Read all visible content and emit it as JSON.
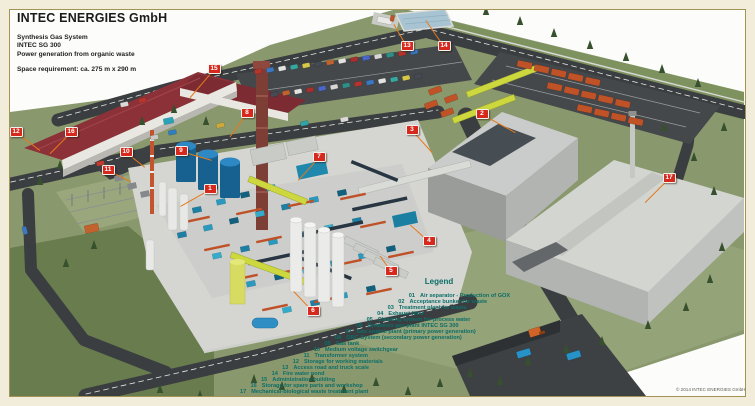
{
  "header": {
    "company": "INTEC ENERGIES GmbH",
    "line1": "Synthesis Gas System",
    "line2": "INTEC SG 300",
    "line3": "Power generation from organic waste",
    "space_requirement": "Space requirement: ca. 275 m x 290 m"
  },
  "legend": {
    "title": "Legend",
    "items": [
      {
        "num": "01",
        "label": "Air separator - Production of GOX"
      },
      {
        "num": "02",
        "label": "Acceptance bunker for waste"
      },
      {
        "num": "03",
        "label": "Treatment plant for waste"
      },
      {
        "num": "04",
        "label": "Exhaust filter"
      },
      {
        "num": "05",
        "label": "Cleaning system for process water"
      },
      {
        "num": "06",
        "label": "Synthesis gas plant INTEC SG 300"
      },
      {
        "num": "07",
        "label": "Gas engine plant (primary power generation)"
      },
      {
        "num": "08",
        "label": "ORC-System (secondary power generation)"
      },
      {
        "num": "09",
        "label": "Gas tank"
      },
      {
        "num": "10",
        "label": "Medium voltage switchgear"
      },
      {
        "num": "11",
        "label": "Transformer system"
      },
      {
        "num": "12",
        "label": "Storage for working materials"
      },
      {
        "num": "13",
        "label": "Access road and truck scale"
      },
      {
        "num": "14",
        "label": "Fire water pond"
      },
      {
        "num": "15",
        "label": "Administration building"
      },
      {
        "num": "16",
        "label": "Storage for spare parts and workshop"
      },
      {
        "num": "17",
        "label": "Mechanical-biological waste treatment plant"
      }
    ]
  },
  "markers": [
    {
      "label": "1",
      "x": 210,
      "y": 189,
      "tx": 180,
      "ty": 206
    },
    {
      "label": "2",
      "x": 482,
      "y": 114,
      "tx": 515,
      "ty": 132
    },
    {
      "label": "3",
      "x": 412,
      "y": 130,
      "tx": 432,
      "ty": 152
    },
    {
      "label": "4",
      "x": 429,
      "y": 241,
      "tx": 410,
      "ty": 224
    },
    {
      "label": "5",
      "x": 391,
      "y": 271,
      "tx": 380,
      "ty": 255
    },
    {
      "label": "6",
      "x": 313,
      "y": 311,
      "tx": 294,
      "ty": 291
    },
    {
      "label": "7",
      "x": 319,
      "y": 157,
      "tx": 298,
      "ty": 180
    },
    {
      "label": "8",
      "x": 247,
      "y": 113,
      "tx": 230,
      "ty": 136
    },
    {
      "label": "9",
      "x": 181,
      "y": 151,
      "tx": 212,
      "ty": 160
    },
    {
      "label": "10",
      "x": 126,
      "y": 152,
      "tx": 145,
      "ty": 167
    },
    {
      "label": "11",
      "x": 108,
      "y": 170,
      "tx": 130,
      "ty": 181
    },
    {
      "label": "12",
      "x": 16,
      "y": 132,
      "tx": 40,
      "ty": 150
    },
    {
      "label": "13",
      "x": 407,
      "y": 46,
      "tx": 394,
      "ty": 24
    },
    {
      "label": "14",
      "x": 444,
      "y": 46,
      "tx": 426,
      "ty": 20
    },
    {
      "label": "15",
      "x": 214,
      "y": 69,
      "tx": 190,
      "ty": 97
    },
    {
      "label": "16",
      "x": 71,
      "y": 132,
      "tx": 50,
      "ty": 153
    },
    {
      "label": "17",
      "x": 669,
      "y": 178,
      "tx": 645,
      "ty": 202
    }
  ],
  "footer": {
    "copyright": "© 2014 INTEC ENERGIES GmbH"
  },
  "colors": {
    "marker_red": "#d6281c",
    "leader_orange": "#e5791c",
    "legend_teal": "#0c6e68",
    "frame_cream": "#f2ecda",
    "frame_line_olive": "#a39355",
    "grass_green": "#8a996d",
    "road_asphalt": "#3b3e41",
    "admin_roof_red": "#8c3138",
    "crane_yellow": "#ccd83e",
    "equipment_teal": "#1d7fa3",
    "equipment_orange": "#bf5128",
    "tank_blue": "#16618f",
    "pond_blue": "#a8c4d2"
  }
}
